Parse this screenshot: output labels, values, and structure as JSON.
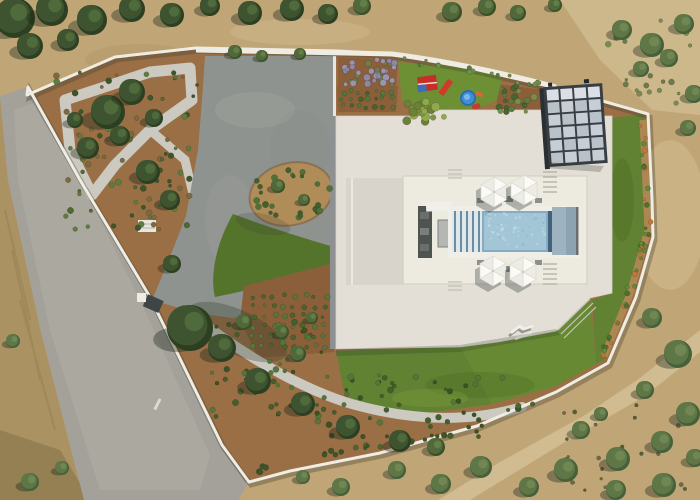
{
  "scene": {
    "description": "Aerial top-down drone photo of a modern white flat-roof villa with central patio and swimming pool, sun umbrellas, solar panels, bright lawns, ornamental gardens with gravel paths, a white perimeter wall, an asphalt access road on the left and dry Mediterranean terrain with olive trees around",
    "inventory": [
      "access-road",
      "perimeter-wall",
      "entrance-gate",
      "gravel-garden-path",
      "ornamental-garden",
      "concrete-courtyard",
      "planted-island",
      "lawns",
      "lavender-bed",
      "plant-rows",
      "children-playground",
      "red-playhouse",
      "red-slide",
      "blue-paddling-pool",
      "villa-flat-roof",
      "inner-patio",
      "swimming-pool",
      "pool-steps",
      "sun-umbrellas",
      "outdoor-kitchen",
      "sun-lounger",
      "solar-panel-array",
      "dry-terrain",
      "olive-grove"
    ]
  },
  "palette": {
    "terrain_base": "#c0a576",
    "terrain_light": "#d6c49a",
    "terrain_dark": "#a98f60",
    "left_strip": "#ab9263",
    "road": "#a4a19a",
    "road_light": "#b6b3ab",
    "soil": "#9a6f45",
    "soil_dark": "#8a5f3a",
    "gravel": "#ccc9c1",
    "concrete": "#8f938f",
    "island_gravel": "#b08c58",
    "wall_white": "#efece3",
    "curb_white": "#e9e6df",
    "lawn": "#618232",
    "lawn_dark": "#55742b",
    "lawn_bright": "#6e9034",
    "roof": "#e3dfd7",
    "roof_inset": "#d8d4cb",
    "patio_floor": "#edebdf",
    "roof_edge_shadow": "#8e9092",
    "pool_water": "#a3c6d7",
    "pool_divider": "#44607a",
    "pool_basin": "#9db3bf",
    "pool_step_base": "#dfe7ea",
    "pool_step_stripe": "#6a8da3",
    "deck_white": "#f0eee8",
    "kitchen_dark": "#4f5451",
    "table_gray": "#b4b7b2",
    "solar_cell": "#c7ced5",
    "solar_cell_alt": "#bac2c9",
    "solar_cell_top": "#d9dfe4",
    "solar_frame": "#383e43",
    "play_red": "#c62f28",
    "play_blue": "#3f8fd6",
    "play_orange": "#d96a2d",
    "mulch": "#ad8753"
  },
  "tree_tones": [
    "#3e5430",
    "#51693a",
    "#5f7747"
  ],
  "tree_rims": [
    "#2c3f20",
    "#3a5128",
    "#46603a"
  ],
  "tree_lights": [
    "#55703f",
    "#68834c",
    "#748b58"
  ],
  "trees": [
    [
      15,
      18,
      20,
      0
    ],
    [
      52,
      10,
      16,
      0
    ],
    [
      92,
      20,
      15,
      0
    ],
    [
      132,
      9,
      13,
      0
    ],
    [
      172,
      15,
      12,
      0
    ],
    [
      210,
      6,
      10,
      0
    ],
    [
      250,
      13,
      12,
      0
    ],
    [
      292,
      9,
      12,
      0
    ],
    [
      328,
      14,
      10,
      0
    ],
    [
      362,
      6,
      9,
      1
    ],
    [
      30,
      46,
      13,
      0
    ],
    [
      68,
      40,
      11,
      0
    ],
    [
      452,
      12,
      10,
      1
    ],
    [
      487,
      7,
      9,
      1
    ],
    [
      518,
      13,
      8,
      1
    ],
    [
      555,
      5,
      7,
      1
    ],
    [
      235,
      52,
      7,
      1
    ],
    [
      262,
      56,
      6,
      1
    ],
    [
      300,
      54,
      6,
      1
    ],
    [
      622,
      30,
      10,
      2
    ],
    [
      652,
      45,
      12,
      2
    ],
    [
      684,
      24,
      10,
      2
    ],
    [
      641,
      69,
      8,
      2
    ],
    [
      669,
      58,
      9,
      2
    ],
    [
      694,
      94,
      9,
      2
    ],
    [
      688,
      128,
      8,
      2
    ],
    [
      108,
      112,
      17,
      0
    ],
    [
      132,
      92,
      13,
      0
    ],
    [
      88,
      148,
      11,
      0
    ],
    [
      148,
      172,
      12,
      0
    ],
    [
      170,
      200,
      10,
      0
    ],
    [
      120,
      136,
      10,
      0
    ],
    [
      154,
      118,
      9,
      0
    ],
    [
      75,
      120,
      8,
      0
    ],
    [
      190,
      328,
      23,
      0
    ],
    [
      172,
      264,
      9,
      0
    ],
    [
      13,
      341,
      7,
      2
    ],
    [
      278,
      186,
      7,
      1
    ],
    [
      304,
      200,
      6,
      1
    ],
    [
      282,
      332,
      7,
      1
    ],
    [
      312,
      318,
      6,
      1
    ],
    [
      222,
      348,
      14,
      0
    ],
    [
      258,
      381,
      13,
      0
    ],
    [
      303,
      404,
      12,
      0
    ],
    [
      348,
      427,
      12,
      0
    ],
    [
      400,
      441,
      11,
      0
    ],
    [
      298,
      354,
      8,
      1
    ],
    [
      436,
      447,
      9,
      1
    ],
    [
      244,
      322,
      8,
      1
    ],
    [
      652,
      318,
      10,
      2
    ],
    [
      678,
      354,
      14,
      2
    ],
    [
      645,
      390,
      9,
      2
    ],
    [
      688,
      414,
      12,
      2
    ],
    [
      662,
      442,
      11,
      2
    ],
    [
      618,
      459,
      12,
      2
    ],
    [
      581,
      430,
      9,
      2
    ],
    [
      601,
      414,
      7,
      2
    ],
    [
      566,
      470,
      12,
      2
    ],
    [
      529,
      487,
      10,
      2
    ],
    [
      481,
      467,
      11,
      2
    ],
    [
      441,
      484,
      10,
      2
    ],
    [
      397,
      470,
      9,
      2
    ],
    [
      341,
      487,
      9,
      2
    ],
    [
      303,
      477,
      7,
      2
    ],
    [
      664,
      485,
      12,
      2
    ],
    [
      616,
      490,
      10,
      2
    ],
    [
      695,
      458,
      9,
      2
    ],
    [
      30,
      482,
      9,
      2
    ],
    [
      62,
      468,
      7,
      2
    ]
  ],
  "shrub_patches": [
    {
      "name": "triangle-garden-shrubs",
      "kind": "rect",
      "x": 55,
      "y": 72,
      "w": 145,
      "h": 158,
      "n": 85,
      "rmin": 1.5,
      "rmax": 3.2,
      "colors": [
        "#4d6a33",
        "#3c552a",
        "#5e7c3f",
        "#7a6a42"
      ]
    },
    {
      "name": "west-bed-rows",
      "kind": "grid",
      "x": 248,
      "y": 292,
      "w": 82,
      "h": 58,
      "cols": 8,
      "rows": 6,
      "jitter": 2.5,
      "r": 2.2,
      "colors": [
        "#57773a",
        "#49652f"
      ]
    },
    {
      "name": "lavender-bed",
      "kind": "rect",
      "x": 340,
      "y": 59,
      "w": 55,
      "h": 26,
      "n": 38,
      "rmin": 2,
      "rmax": 3.6,
      "colors": [
        "#8f87a6",
        "#9b93b2",
        "#6f7d4a"
      ]
    },
    {
      "name": "north-plant-rows",
      "kind": "grid",
      "x": 339,
      "y": 88,
      "w": 56,
      "h": 22,
      "cols": 7,
      "rows": 3,
      "jitter": 2,
      "r": 2.2,
      "colors": [
        "#55753a",
        "#47632e"
      ]
    },
    {
      "name": "north-east-bed",
      "kind": "rect",
      "x": 499,
      "y": 86,
      "w": 44,
      "h": 26,
      "n": 22,
      "rmin": 1.8,
      "rmax": 3.4,
      "colors": [
        "#5a7d3c",
        "#72904a",
        "#4a6430"
      ]
    },
    {
      "name": "hedge-cluster",
      "kind": "rect",
      "x": 402,
      "y": 100,
      "w": 42,
      "h": 22,
      "n": 20,
      "rmin": 2.5,
      "rmax": 4.5,
      "colors": [
        "#7f9440",
        "#92a84e",
        "#6c8038"
      ]
    },
    {
      "name": "island-ring",
      "kind": "ellipse",
      "cx": 291,
      "cy": 194,
      "rx": 34,
      "ry": 22,
      "n": 24,
      "rmin": 1.8,
      "rmax": 3.2,
      "colors": [
        "#50703a",
        "#42602e"
      ]
    },
    {
      "name": "right-wall-strip",
      "kind": "line",
      "pts": [
        [
          643,
          122
        ],
        [
          648,
          230
        ],
        [
          630,
          294
        ],
        [
          604,
          355
        ]
      ],
      "n": 42,
      "jitter": 4,
      "rmin": 1.5,
      "rmax": 2.8,
      "colors": [
        "#4f7030",
        "#62883a",
        "#c1773a"
      ]
    },
    {
      "name": "bottom-strip-a",
      "kind": "rect",
      "x": 212,
      "y": 322,
      "w": 110,
      "h": 95,
      "n": 50,
      "rmin": 1.5,
      "rmax": 3.2,
      "colors": [
        "#445f2d",
        "#55763a",
        "#3a5226"
      ]
    },
    {
      "name": "bottom-strip-b",
      "kind": "rect",
      "x": 310,
      "y": 375,
      "w": 195,
      "h": 62,
      "n": 50,
      "rmin": 1.5,
      "rmax": 3.2,
      "colors": [
        "#445f2d",
        "#55763a",
        "#3a5226"
      ]
    },
    {
      "name": "bottom-wall-row",
      "kind": "line",
      "pts": [
        [
          253,
          470
        ],
        [
          350,
          451
        ],
        [
          468,
          428
        ],
        [
          545,
          397
        ]
      ],
      "n": 30,
      "jitter": 4,
      "rmin": 1.8,
      "rmax": 3.2,
      "colors": [
        "#3c5528",
        "#4a6732"
      ]
    },
    {
      "name": "grove-floor",
      "kind": "rect",
      "x": 556,
      "y": 398,
      "w": 140,
      "h": 98,
      "n": 26,
      "rmin": 1.2,
      "rmax": 2.4,
      "colors": [
        "#6f6a45",
        "#55603a"
      ]
    },
    {
      "name": "top-right-scrub",
      "kind": "rect",
      "x": 608,
      "y": 16,
      "w": 88,
      "h": 92,
      "n": 22,
      "rmin": 1.5,
      "rmax": 3,
      "colors": [
        "#6c7a4a",
        "#7b8a52"
      ]
    },
    {
      "name": "north-walk-edge",
      "kind": "line",
      "pts": [
        [
          398,
          60
        ],
        [
          470,
          70
        ],
        [
          540,
          84
        ]
      ],
      "n": 18,
      "jitter": 3,
      "rmin": 1.5,
      "rmax": 2.6,
      "colors": [
        "#5a7d3c",
        "#6f8f4a"
      ]
    }
  ],
  "umbrellas": [
    [
      494,
      192
    ],
    [
      524,
      190
    ],
    [
      493,
      271
    ],
    [
      523,
      272
    ]
  ],
  "solar": {
    "x": 547,
    "y": 86,
    "w": 57,
    "h": 78,
    "cols": 4,
    "rows": 6,
    "gap": 2,
    "angle": -4,
    "cx": 576,
    "cy": 125
  },
  "pool_speckle": {
    "x": 485,
    "y": 213,
    "w": 61,
    "h": 36,
    "n": 55
  }
}
